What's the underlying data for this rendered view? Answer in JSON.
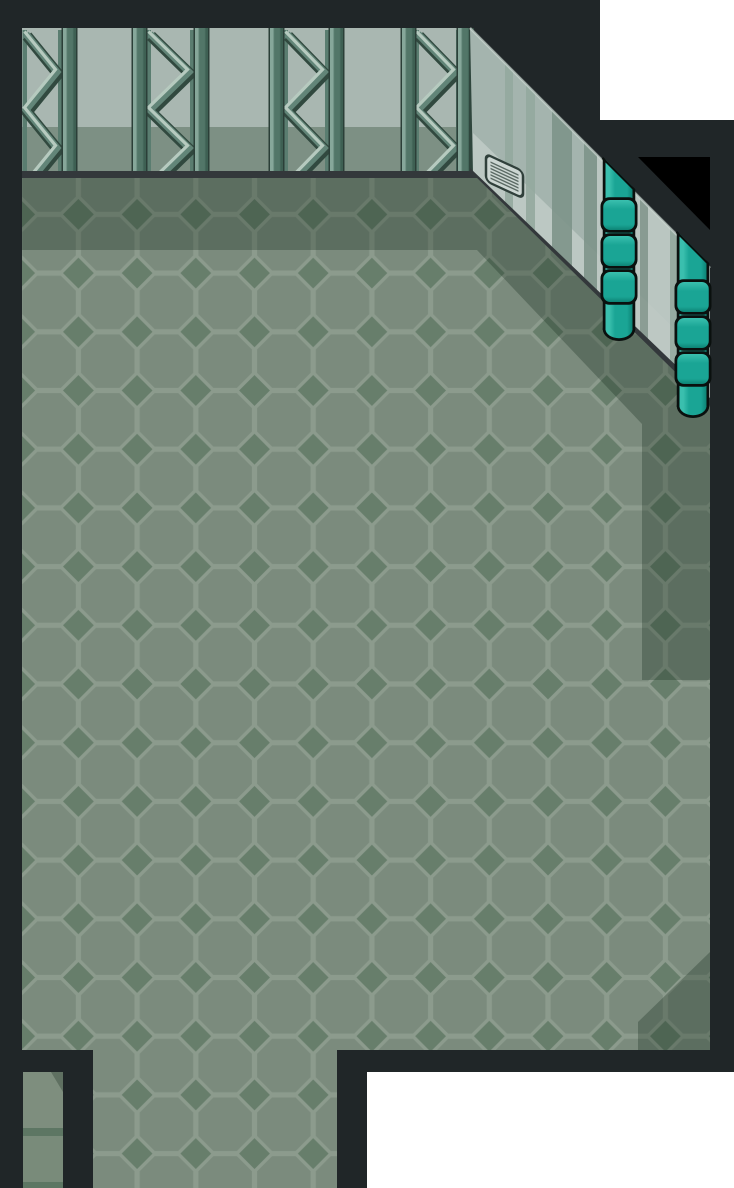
{
  "meta": {
    "title": "Warehouse interior game map",
    "type": "game-screenshot",
    "width": 734,
    "height": 1188
  },
  "scene": {
    "objects": [
      {
        "name": "map-border",
        "desc": "dark charcoal wall border framing the room"
      },
      {
        "name": "girder-wall",
        "desc": "top wall with steel truss girders between teal pillars"
      },
      {
        "name": "diagonal-wall",
        "desc": "diagonal striped wall running to lower right"
      },
      {
        "name": "wall-vent",
        "desc": "small louvered vent plate on diagonal wall"
      },
      {
        "name": "teal-pipe",
        "desc": "two vertical teal pipes with ring couplings"
      },
      {
        "name": "tiled-floor",
        "desc": "octagon and diamond tiled floor"
      },
      {
        "name": "floor-shadow",
        "desc": "shadow cast by walls onto floor"
      },
      {
        "name": "south-exit",
        "desc": "wide floor opening leading off bottom edge"
      },
      {
        "name": "west-corridor",
        "desc": "narrow plain-floor corridor at bottom left"
      },
      {
        "name": "outside-area",
        "desc": "white regions outside the map"
      },
      {
        "name": "corner-void",
        "desc": "black triangular void at top right corner"
      }
    ]
  },
  "colors": {
    "charcoal": "#202628",
    "void_black": "#000000",
    "outside_white": "#ffffff",
    "wall_top_face": "#a9b7b1",
    "wall_top_band": "#7d9084",
    "face_base": "#a4b4ae",
    "face_light_band": "#bfcac5",
    "face_rim": "#ccd8d2",
    "stripe_mid": "#93a89e",
    "stripe_mid2": "#85988f",
    "stripe_dark": "#7d948a",
    "stripe_light": "#bcc8c3",
    "junction": "#33383b",
    "pillar_light": "#86a79a",
    "pillar_mid": "#527668",
    "pillar_dark": "#3e6053",
    "pillar_edge": "#2b3f38",
    "corner_edge": "#2f463d",
    "truss_rail": "#5a7d70",
    "truss_dark": "#31493f",
    "truss_mid": "#628578",
    "truss_light": "#b6cabf",
    "floor_grout": "#8c9b8d",
    "floor_octagon": "#7b8b7d",
    "floor_diamond": "#677e6b",
    "shadow_overlay": "#0f2416",
    "corridor_floor": "#7e8e7e",
    "corridor_floor_low": "#798b7a",
    "corridor_seam": "#5d7663",
    "pipe_outline": "#0a100e",
    "pipe_hi": "#3abfae",
    "pipe_main": "#1aa595",
    "pipe_dark": "#0d8475",
    "vent_fill": "#ccd6d2",
    "vent_line": "#5b6a64",
    "vent_outline": "#30403b"
  },
  "structure": {
    "top_wall": {
      "x": 22,
      "y": 28,
      "w": 452,
      "h": 145,
      "band_y": 127,
      "pillar_w": 13,
      "pillar_xs": [
        63,
        133,
        195,
        270,
        330,
        402,
        458
      ],
      "truss_bays": [
        {
          "l": 22,
          "r": 63
        },
        {
          "l": 146,
          "r": 195
        },
        {
          "l": 283,
          "r": 330
        },
        {
          "l": 414,
          "r": 461
        }
      ]
    },
    "diag_wall": {
      "stripes": [
        {
          "x": 505,
          "w": 8,
          "tone": "mid"
        },
        {
          "x": 526,
          "w": 9,
          "tone": "mid"
        },
        {
          "x": 552,
          "w": 20,
          "tone": "dark"
        },
        {
          "x": 584,
          "w": 13,
          "tone": "dark"
        },
        {
          "x": 597,
          "w": 43,
          "tone": "light"
        },
        {
          "x": 640,
          "w": 8,
          "tone": "mid2"
        },
        {
          "x": 648,
          "w": 22,
          "tone": "light"
        },
        {
          "x": 670,
          "w": 8,
          "tone": "mid"
        }
      ]
    },
    "pipes": [
      {
        "cx": 619,
        "top": 150,
        "tube_bottom": 330,
        "cap_cy": 329,
        "rings": [
          200,
          236,
          272
        ]
      },
      {
        "cx": 693,
        "top": 224,
        "tube_bottom": 407,
        "cap_cy": 406,
        "rings": [
          282,
          318,
          354
        ]
      }
    ],
    "floor": {
      "tile": 58.7,
      "pattern_x": 19.7,
      "pattern_y": 155.7
    }
  }
}
